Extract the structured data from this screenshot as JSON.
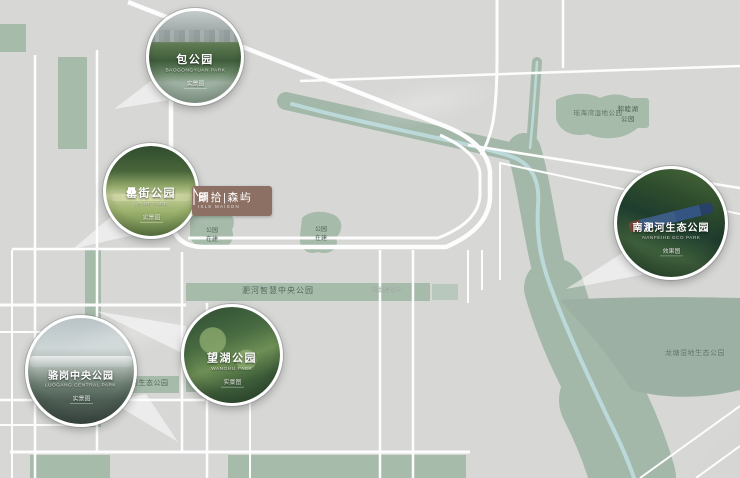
{
  "logo": {
    "cn": "朗拾|森屿",
    "en": "ISLE MAISON"
  },
  "callouts": [
    {
      "name": "包公园",
      "en": "BAOGONGYUAN PARK",
      "tag": "实景图"
    },
    {
      "name": "罍街公园",
      "en": "LEIJIE PARK",
      "tag": "实景图"
    },
    {
      "name": "望湖公园",
      "en": "WANGHU PARK",
      "tag": "实景图"
    },
    {
      "name": "骆岗中央公园",
      "en": "LUOGANG CENTRAL PARK",
      "tag": "实景图"
    },
    {
      "name": "南淝河生态公园",
      "en": "NANFEIHE ECO PARK",
      "tag": "效果图"
    }
  ],
  "map_labels": {
    "feihe_smart_central_park": "淝河智慧中央公园",
    "feihe_smart_note": "规划建设中",
    "feihe_eco_park": "淝河生态公园",
    "longtang_wetland_park": "龙塘湿地生态公园",
    "yaohaiwan_wetland_park": "瑶海湾湿地公园",
    "hemuhu_park_line1": "和睦湖",
    "hemuhu_park_line2": "公园",
    "park_blob_line1": "公园",
    "park_blob_line2": "在建"
  },
  "colors": {
    "map_bg": "#d7d8d6",
    "park_green": "#a7bbab",
    "river": "#bcd9da",
    "logo_brown": "#8c7063",
    "road_white": "#ffffff"
  }
}
